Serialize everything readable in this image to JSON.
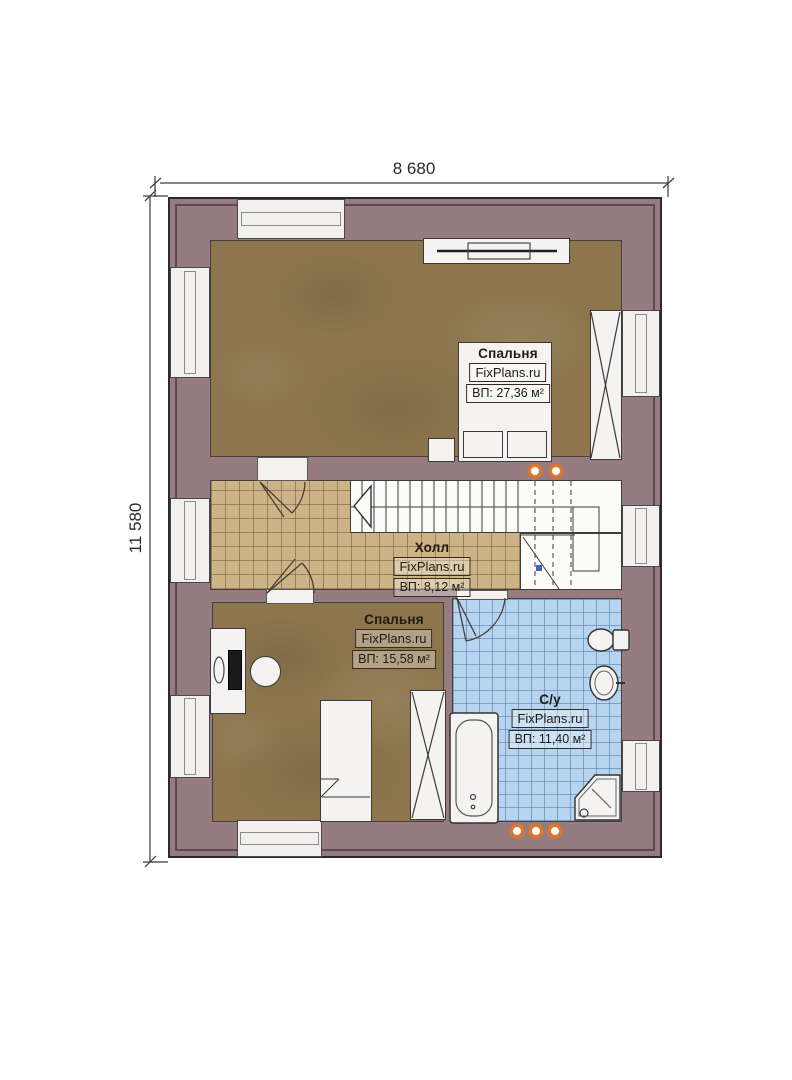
{
  "meta": {
    "type": "floor-plan",
    "floor": "second"
  },
  "watermark": "FixPlans.ru",
  "dimensions": {
    "top": "8 680",
    "left": "11 580"
  },
  "rooms": [
    {
      "name": "Спальня",
      "area": "ВП: 27,36 м²"
    },
    {
      "name": "Холл",
      "area": "ВП: 8,12 м²"
    },
    {
      "name": "Спальня",
      "area": "ВП: 15,58 м²"
    },
    {
      "name": "С/у",
      "area": "ВП: 11,40 м²"
    }
  ],
  "colors": {
    "wall": "#967c80",
    "wood_floor": "#8d764d",
    "hall_tile": "#cdb486",
    "bath_tile": "#b6d4f0",
    "fixture_white": "#f4f3f1",
    "accent_orange": "#e0762c",
    "dim_text": "#2b2b2b"
  }
}
